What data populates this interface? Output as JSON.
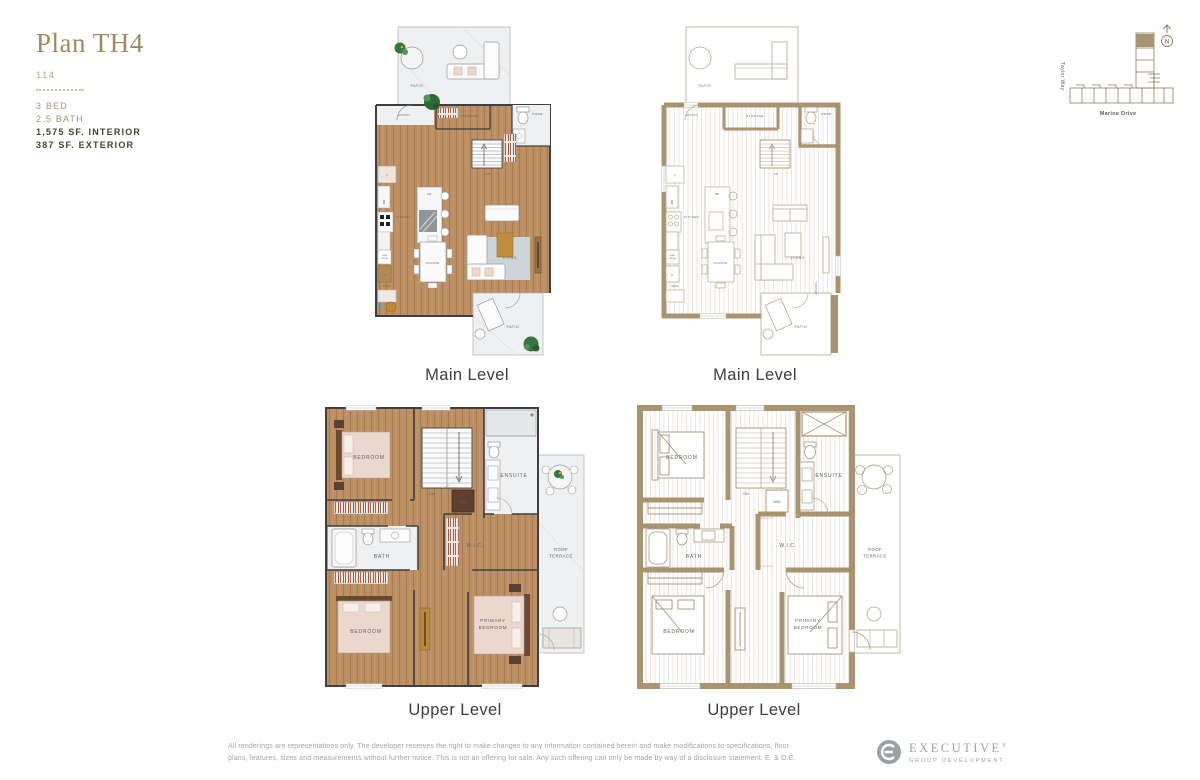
{
  "header": {
    "plan_name": "Plan TH4",
    "unit_number": "114",
    "bed": "3 BED",
    "bath": "2.5 BATH",
    "interior_area": "1,575 SF. INTERIOR",
    "exterior_area": "387 SF. EXTERIOR"
  },
  "captions": {
    "main_left": "Main Level",
    "main_right": "Main Level",
    "upper_left": "Upper Level",
    "upper_right": "Upper Level"
  },
  "rooms_main": {
    "patio_top": "PATIO",
    "entry": "ENTRY",
    "storage": "STORAGE",
    "pwdr": "PWDR.",
    "up": "UP",
    "kitchen": "KITCHEN",
    "dw": "DW",
    "mw": "MW",
    "fridge": "F",
    "wine1": "WINE",
    "wine2": "FRIDGE",
    "pantry": "P",
    "nook": "NOOK",
    "dining": "DINING",
    "living": "LIVING",
    "dining_door": "DINING",
    "patio_bottom": "PATIO"
  },
  "rooms_upper": {
    "bedroom_top": "BEDROOM",
    "dn": "DN",
    "wd": "W/D",
    "ensuite": "ENSUITE",
    "bath": "BATH",
    "wic": "W.I.C.",
    "bedroom_bottom": "BEDROOM",
    "primary1": "PRIMARY",
    "primary2": "BEDROOM",
    "roof1": "ROOF",
    "roof2": "TERRACE"
  },
  "sitemap": {
    "street_left": "Taylor Way",
    "street_bottom": "Marine Drive",
    "north_label": "N"
  },
  "footer": {
    "disclaimer_line1": "All renderings are representations only. The developer reserves the right to make changes to any information contained herein and make modifications to specifications, floor",
    "disclaimer_line2": "plans, features, sizes and measurements without further notice. This is not an offering for sale. Any such offering can only be made by way of a disclosure statement. E. & O.E.",
    "logo_name": "EXECUTIVE",
    "logo_reg": "®",
    "logo_sub": "GROUP DEVELOPMENT"
  },
  "colors": {
    "gold_heading": "#a08a5f",
    "tan_wall": "#a9946f",
    "wood_floor": "#bb8e63",
    "unit_highlight": "#a9946f",
    "caption_text": "#3d3d3d",
    "disclaimer_gray": "#a3a3a3",
    "logo_gray": "#9aa0a4"
  }
}
